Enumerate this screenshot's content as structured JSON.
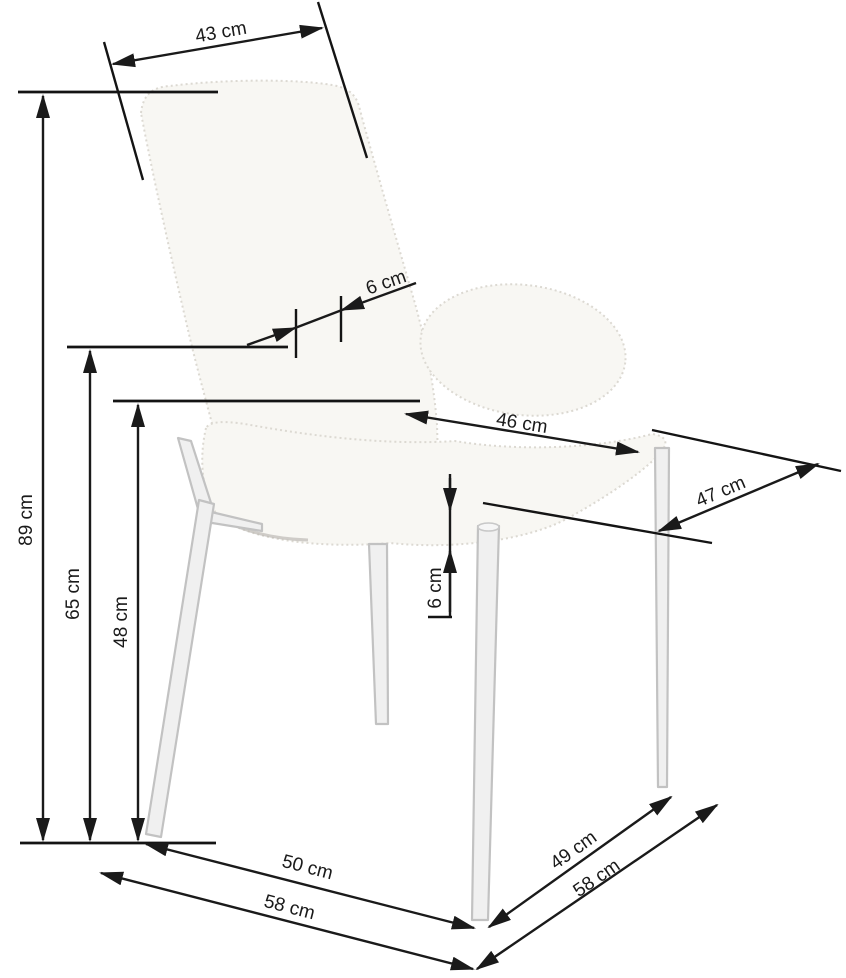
{
  "diagram": {
    "type": "product-dimension-diagram",
    "subject": "upholstered boucle chair with tapered legs, three-quarter view",
    "unit": "cm",
    "labels": {
      "backrest_width": "43 cm",
      "backrest_thickness": "6 cm",
      "total_height": "89 cm",
      "armrest_height": "65 cm",
      "seat_height": "48 cm",
      "seat_width": "46 cm",
      "seat_depth": "47 cm",
      "seat_cushion_thickness": "6 cm",
      "front_base_width": "50 cm",
      "overall_width": "58 cm",
      "side_base_depth": "49 cm",
      "overall_depth": "58 cm"
    },
    "colors": {
      "dimension_lines": "#1a1a1a",
      "chair_fill": "#f8f7f3",
      "chair_outline": "#dcd9d2",
      "leg_fill": "#f0f0f0",
      "leg_outline": "#c2c2c2",
      "background": "#ffffff"
    }
  }
}
